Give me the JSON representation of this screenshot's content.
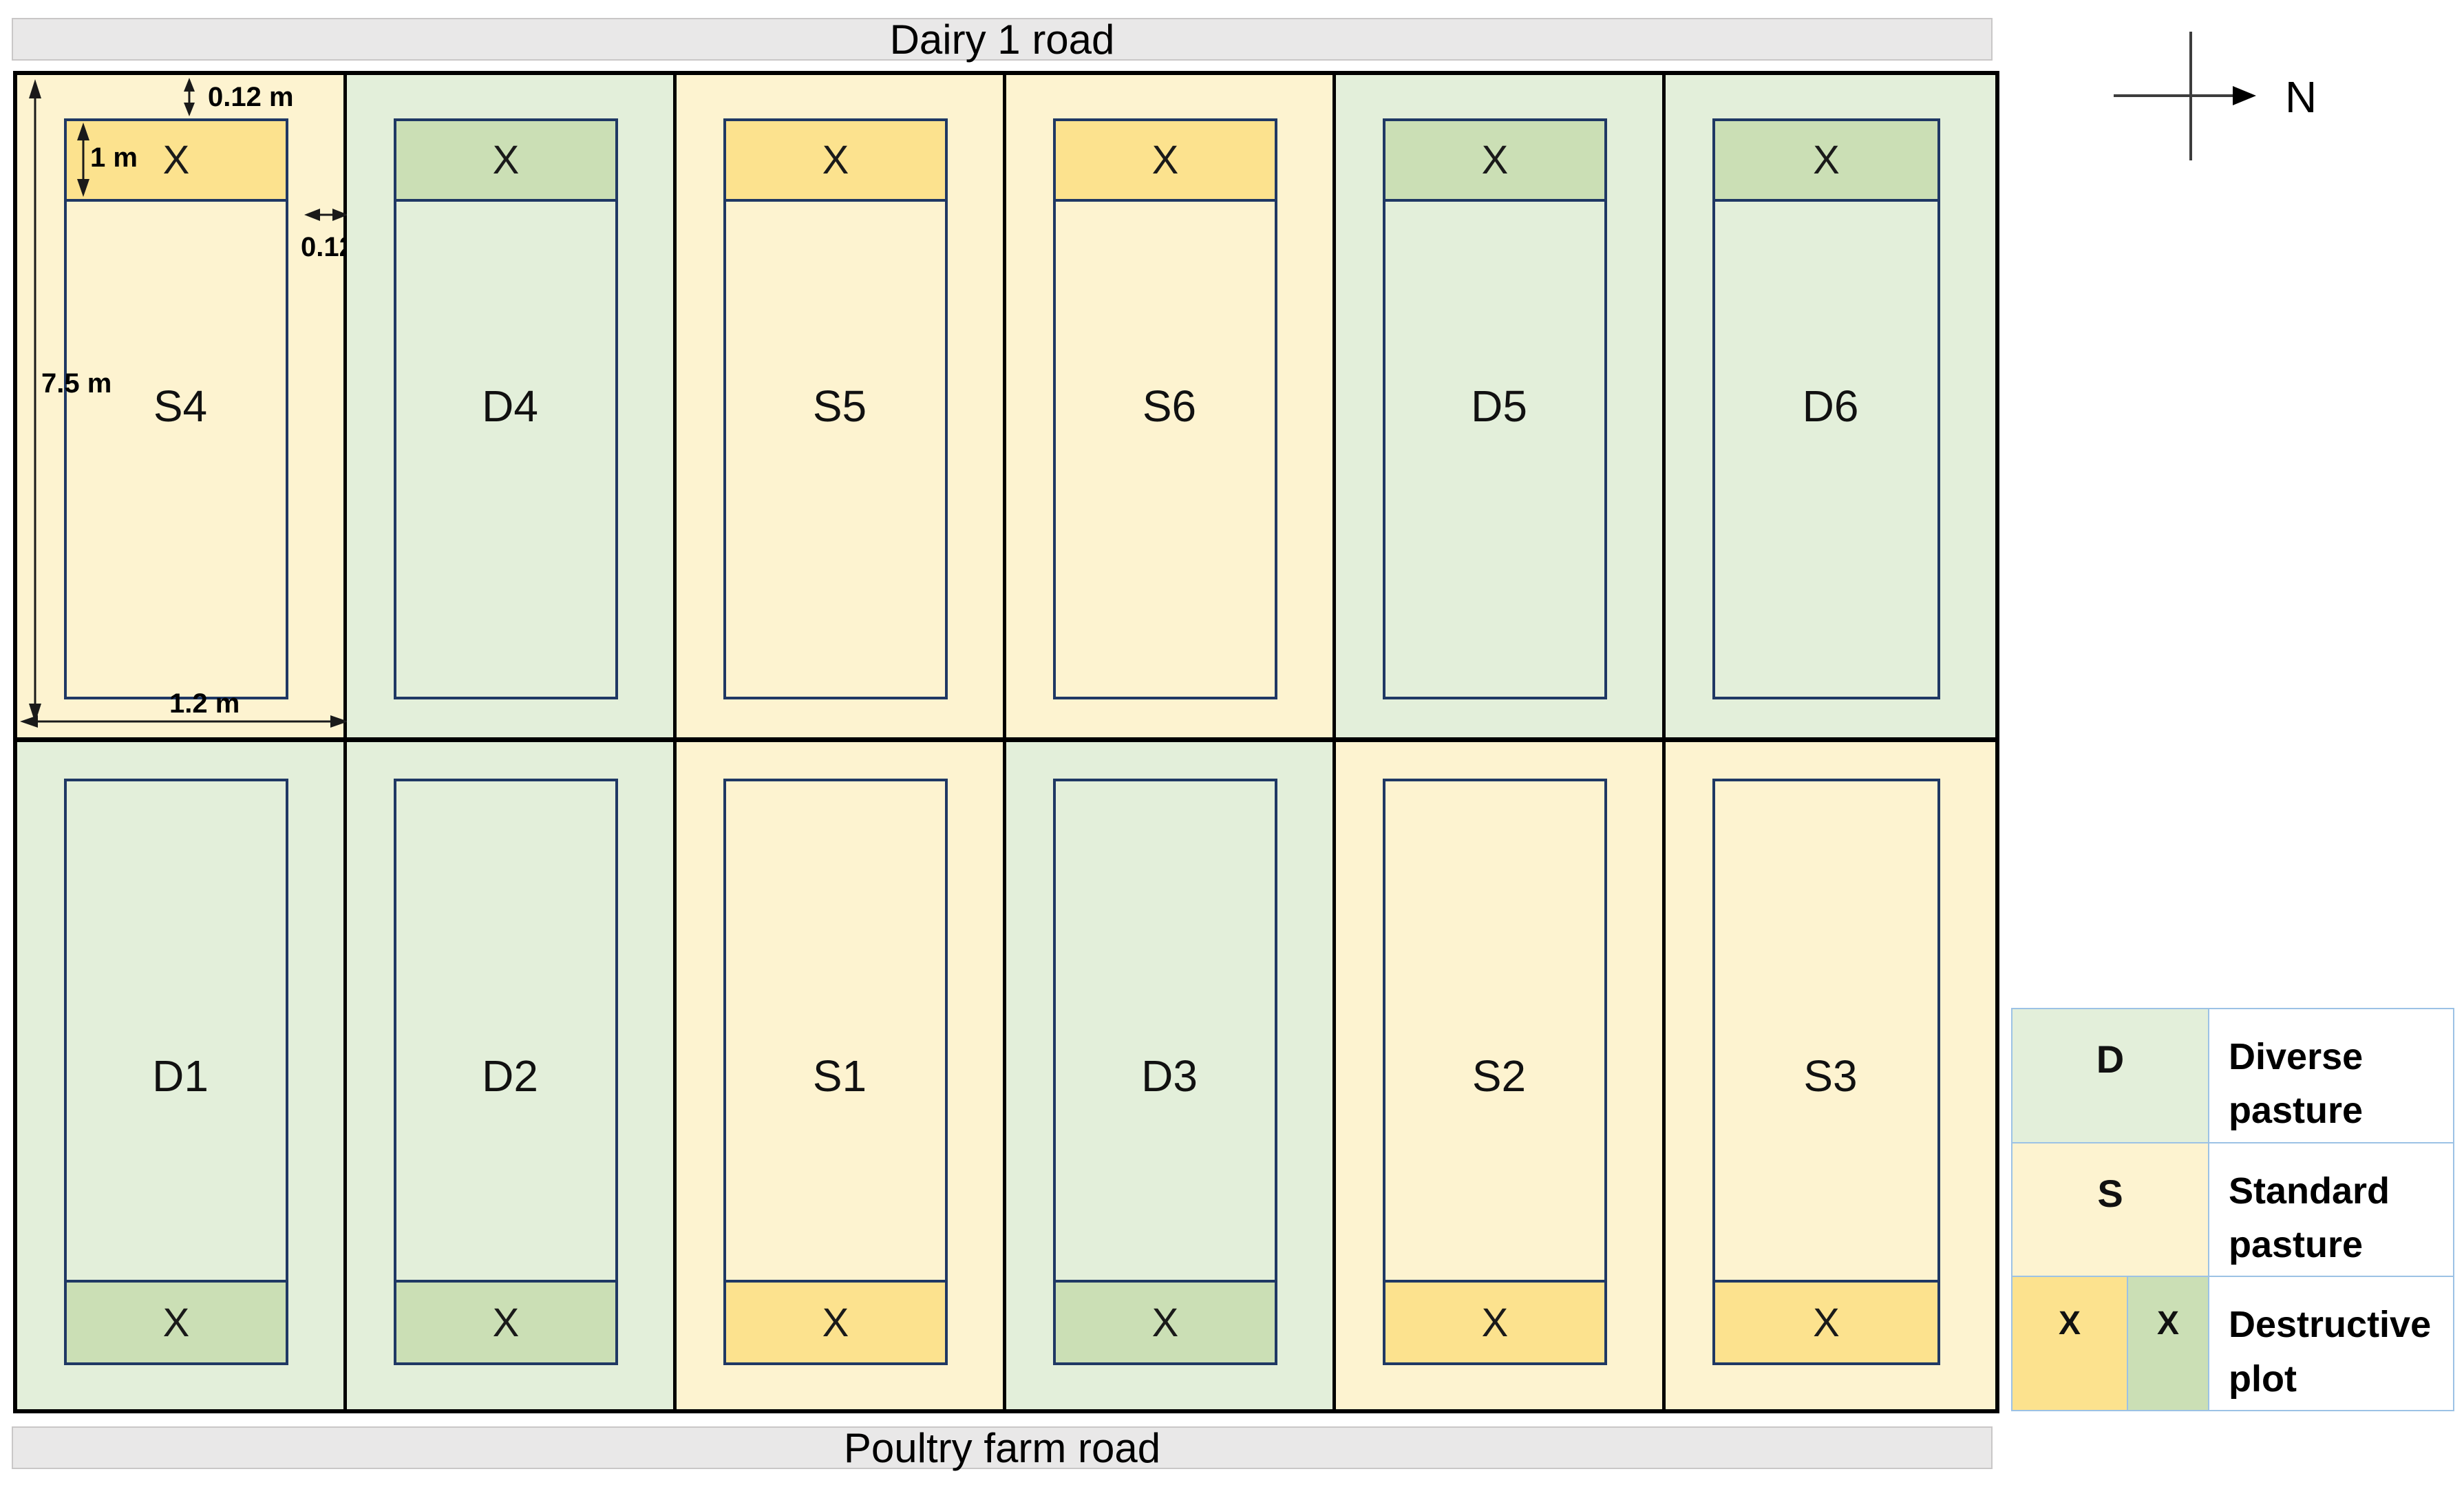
{
  "roads": {
    "top_label": "Dairy 1 road",
    "bottom_label": "Poultry farm road"
  },
  "compass": {
    "label": "N"
  },
  "field": {
    "rows": [
      {
        "plots": [
          {
            "id": "S4",
            "type": "S",
            "marker": "X"
          },
          {
            "id": "D4",
            "type": "D",
            "marker": "X"
          },
          {
            "id": "S5",
            "type": "S",
            "marker": "X"
          },
          {
            "id": "S6",
            "type": "S",
            "marker": "X"
          },
          {
            "id": "D5",
            "type": "D",
            "marker": "X"
          },
          {
            "id": "D6",
            "type": "D",
            "marker": "X"
          }
        ]
      },
      {
        "plots": [
          {
            "id": "D1",
            "type": "D",
            "marker": "X"
          },
          {
            "id": "D2",
            "type": "D",
            "marker": "X"
          },
          {
            "id": "S1",
            "type": "S",
            "marker": "X"
          },
          {
            "id": "D3",
            "type": "D",
            "marker": "X"
          },
          {
            "id": "S2",
            "type": "S",
            "marker": "X"
          },
          {
            "id": "S3",
            "type": "S",
            "marker": "X"
          }
        ]
      }
    ]
  },
  "annotations": {
    "top_offset": "0.12 m",
    "strip_height": "1 m",
    "side_offset": "0.12 m",
    "plot_length": "7.5 m",
    "plot_width": "1.2 m"
  },
  "legend": {
    "rows": [
      {
        "symbol": "D",
        "label": "Diverse pasture"
      },
      {
        "symbol": "S",
        "label": "Standard pasture"
      },
      {
        "symbol_standard": "X",
        "symbol_diverse": "X",
        "label": "Destructive plot"
      }
    ]
  },
  "colors": {
    "standard-bg": "#fdf3d0",
    "diverse-bg": "#e3efda",
    "standard-x": "#fce28e",
    "diverse-x": "#cbdfb5",
    "road-bg": "#e9e8e8",
    "road-border": "#c9c7c7",
    "inner-border": "#1f3864",
    "legend-border": "#9cc2e5",
    "line": "#1a1a1a"
  }
}
